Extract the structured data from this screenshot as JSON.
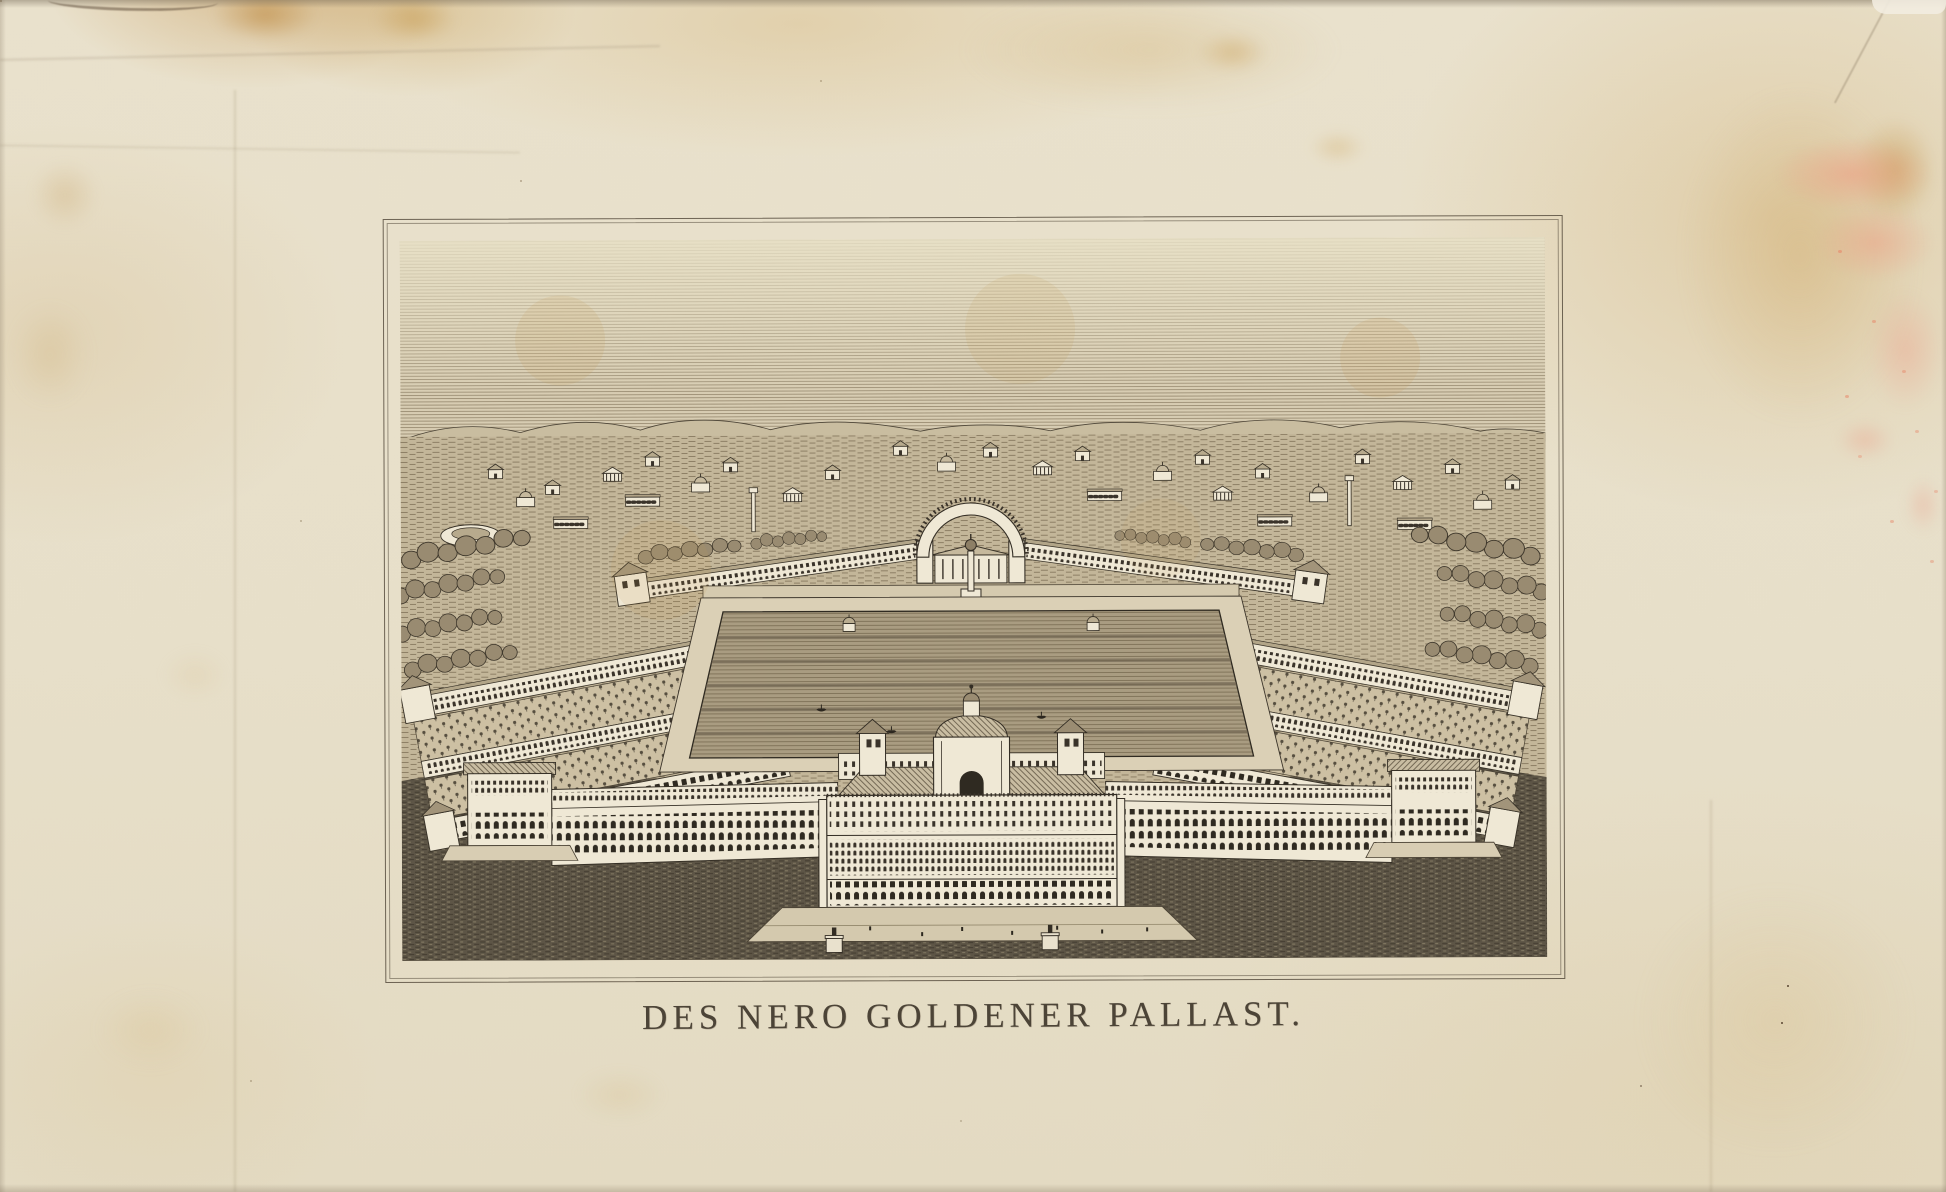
{
  "print": {
    "caption": "DES NERO GOLDENER PALLAST."
  },
  "palette": {
    "paper": "#e7dfca",
    "ink": "#332d24",
    "highlight_white": "#efe8d5",
    "foxing_brown": "#c49544",
    "pink_smudge": "#ee9d84",
    "dark_lawn": "#5d5546",
    "sky_hatch": "#94866c"
  }
}
